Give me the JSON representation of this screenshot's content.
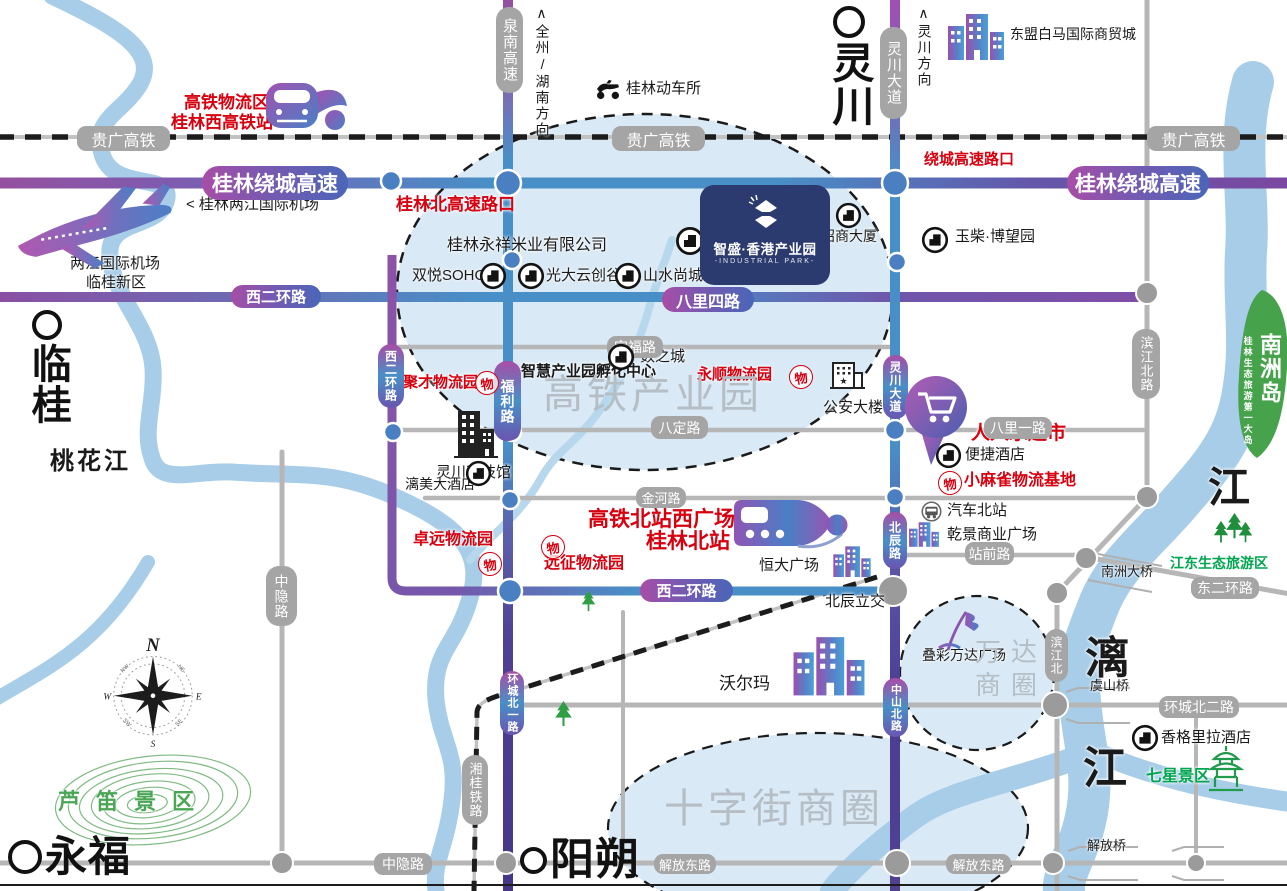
{
  "logo": {
    "title": "智盛·香港产业园",
    "subtitle": "-INDUSTRIAL PARK-"
  },
  "wu_stamp_char": "物",
  "compass": {
    "n": "N",
    "e": "E",
    "s": "S",
    "w": "W",
    "ne": "NE",
    "nw": "NW",
    "se": "SE",
    "sw": "SW"
  },
  "colors": {
    "red": "#d7000f",
    "navy_logo": "#2b3a6f",
    "road_purple": "#8a4fa0",
    "road_blue": "#488fc7",
    "gray_pill": "#a5a5a5",
    "river": "#a8cde8",
    "ellipse_fill": "#d9e9f5",
    "green": "#00a550",
    "island_green": "#46a24b",
    "district_gray": "#b5bdc5"
  },
  "map": {
    "cities": [
      {
        "n": "lingchuan-city",
        "t": "灵川",
        "x": 828,
        "y": 6,
        "vertical": true,
        "ring": 24,
        "fs": 42
      },
      {
        "n": "lingui-city",
        "t": "临桂",
        "x": 27,
        "y": 310,
        "vertical": true,
        "ring": 22,
        "fs": 40
      },
      {
        "n": "yongfu-city",
        "t": "永福",
        "x": 8,
        "y": 836,
        "vertical": false,
        "ring": 26,
        "fs": 42
      },
      {
        "n": "yangshuo-city",
        "t": "阳朔",
        "x": 520,
        "y": 838,
        "vertical": false,
        "ring": 19,
        "fs": 44
      }
    ],
    "labels": [
      {
        "n": "hsr-logistics-zone",
        "t": "高铁物流区",
        "x": 184,
        "y": 93,
        "fs": 17,
        "cls": "red"
      },
      {
        "n": "guilin-west-hsr-station",
        "t": "桂林西高铁站",
        "x": 171,
        "y": 113,
        "fs": 17,
        "cls": "red"
      },
      {
        "n": "guilin-north-expressway-exit",
        "t": "桂林北高速路口",
        "x": 396,
        "y": 195,
        "fs": 17,
        "cls": "red"
      },
      {
        "n": "ring-expressway-exit",
        "t": "绕城高速路口",
        "x": 924,
        "y": 151,
        "fs": 15,
        "cls": "red"
      },
      {
        "n": "yongshun-logistics-park",
        "t": "永顺物流园",
        "x": 697,
        "y": 366,
        "fs": 15,
        "cls": "red"
      },
      {
        "n": "jucai-logistics-park",
        "t": "聚才物流园",
        "x": 403,
        "y": 374,
        "fs": 15,
        "cls": "red"
      },
      {
        "n": "renrenle-supermarket",
        "t": "人人乐超市",
        "x": 971,
        "y": 423,
        "fs": 19,
        "cls": "red"
      },
      {
        "n": "xiaomaque-logistics-base",
        "t": "小麻雀物流基地",
        "x": 964,
        "y": 472,
        "fs": 16,
        "cls": "red"
      },
      {
        "n": "zhuoyuan-logistics-park",
        "t": "卓远物流园",
        "x": 413,
        "y": 531,
        "fs": 16,
        "cls": "red"
      },
      {
        "n": "yuanzheng-logistics-park",
        "t": "远征物流园",
        "x": 544,
        "y": 555,
        "fs": 16,
        "cls": "red"
      },
      {
        "n": "hsr-north-west-square",
        "t": "高铁北站西广场",
        "x": 588,
        "y": 508,
        "fs": 21,
        "cls": "red"
      },
      {
        "n": "guilin-north-station",
        "t": "桂林北站",
        "x": 646,
        "y": 530,
        "fs": 21,
        "cls": "red"
      },
      {
        "n": "guilin-emu-depot",
        "t": "桂林动车所",
        "x": 626,
        "y": 80,
        "fs": 15,
        "cls": "blk"
      },
      {
        "n": "asean-baima-trade-city",
        "t": "东盟白马国际商贸城",
        "x": 1010,
        "y": 26,
        "fs": 14,
        "cls": "blk"
      },
      {
        "n": "liangjiang-airport-pointer",
        "t": "< 桂林两江国际机场",
        "x": 186,
        "y": 196,
        "fs": 15,
        "cls": "blk"
      },
      {
        "n": "liangjiang-airport",
        "t": "两江国际机场",
        "x": 70,
        "y": 255,
        "fs": 15,
        "cls": "blk"
      },
      {
        "n": "lingui-new-district",
        "t": "临桂新区",
        "x": 86,
        "y": 274,
        "fs": 15,
        "cls": "blk"
      },
      {
        "n": "yongxiang-rice-company",
        "t": "桂林永祥米业有限公司",
        "x": 447,
        "y": 237,
        "fs": 16,
        "cls": "blk"
      },
      {
        "n": "zhaoshang-building",
        "t": "招商大厦",
        "x": 821,
        "y": 228,
        "fs": 14,
        "cls": "blk"
      },
      {
        "n": "yuchai-bowang-park",
        "t": "玉柴·博望园",
        "x": 955,
        "y": 228,
        "fs": 15,
        "cls": "blk"
      },
      {
        "n": "shuangyue-soho",
        "t": "双悦SOHO",
        "x": 412,
        "y": 267,
        "fs": 15,
        "cls": "blk"
      },
      {
        "n": "guangda-cloud-valley",
        "t": "光大云创谷",
        "x": 546,
        "y": 267,
        "fs": 15,
        "cls": "blk"
      },
      {
        "n": "shanshui-shangcheng",
        "t": "山水尚城",
        "x": 643,
        "y": 267,
        "fs": 15,
        "cls": "blk"
      },
      {
        "n": "shuzhicheng",
        "t": "数之城",
        "x": 640,
        "y": 348,
        "fs": 15,
        "cls": "blk"
      },
      {
        "n": "lingchuan-science-museum",
        "t": "灵川科技馆",
        "x": 436,
        "y": 464,
        "fs": 15,
        "cls": "blk"
      },
      {
        "n": "smart-park-incubator",
        "t": "智慧产业园孵化中心",
        "x": 521,
        "y": 363,
        "fs": 15,
        "cls": "blk bold"
      },
      {
        "n": "public-security-building",
        "t": "公安大楼",
        "x": 823,
        "y": 399,
        "fs": 15,
        "cls": "blk"
      },
      {
        "n": "limei-hotel",
        "t": "漓美大酒店",
        "x": 405,
        "y": 476,
        "fs": 14,
        "cls": "blk"
      },
      {
        "n": "bianjie-hotel",
        "t": "便捷酒店",
        "x": 965,
        "y": 446,
        "fs": 15,
        "cls": "blk"
      },
      {
        "n": "north-bus-station",
        "t": "汽车北站",
        "x": 947,
        "y": 502,
        "fs": 15,
        "cls": "blk"
      },
      {
        "n": "qianjing-plaza",
        "t": "乾景商业广场",
        "x": 947,
        "y": 526,
        "fs": 15,
        "cls": "blk"
      },
      {
        "n": "hengda-plaza",
        "t": "恒大广场",
        "x": 759,
        "y": 557,
        "fs": 15,
        "cls": "blk"
      },
      {
        "n": "beichen-interchange",
        "t": "北辰立交",
        "x": 825,
        "y": 593,
        "fs": 15,
        "cls": "blk"
      },
      {
        "n": "diecai-wanda-plaza",
        "t": "叠彩万达广场",
        "x": 922,
        "y": 647,
        "fs": 14,
        "cls": "blk"
      },
      {
        "n": "walmart",
        "t": "沃尔玛",
        "x": 719,
        "y": 674,
        "fs": 17,
        "cls": "blk"
      },
      {
        "n": "yushan-bridge",
        "t": "虞山桥",
        "x": 1090,
        "y": 678,
        "fs": 13,
        "cls": "blk"
      },
      {
        "n": "nanzhou-bridge",
        "t": "南洲大桥",
        "x": 1101,
        "y": 564,
        "fs": 13,
        "cls": "blk"
      },
      {
        "n": "shangri-la-hotel",
        "t": "香格里拉酒店",
        "x": 1161,
        "y": 729,
        "fs": 15,
        "cls": "blk"
      },
      {
        "n": "jiefang-bridge",
        "t": "解放桥",
        "x": 1087,
        "y": 838,
        "fs": 13,
        "cls": "blk"
      },
      {
        "n": "jiangdong-eco-tourism",
        "t": "江东生态旅游区",
        "x": 1170,
        "y": 555,
        "fs": 14,
        "cls": "grn"
      },
      {
        "n": "seven-star-park",
        "t": "七星景区",
        "x": 1146,
        "y": 768,
        "fs": 16,
        "cls": "grn"
      },
      {
        "n": "reed-flute-scenic-area",
        "t": "芦笛景区",
        "x": 58,
        "y": 789,
        "fs": 22,
        "cls": "ludi"
      },
      {
        "n": "taohua-river",
        "t": "桃花江",
        "x": 50,
        "y": 448,
        "fs": 24,
        "cls": "blk taohua"
      },
      {
        "n": "hsr-industrial-park-zone",
        "t": "高铁产业园",
        "x": 543,
        "y": 372,
        "fs": 40,
        "cls": "dist"
      },
      {
        "n": "shizijie-business-circle",
        "t": "十字街商圈",
        "x": 664,
        "y": 786,
        "fs": 40,
        "cls": "dist"
      },
      {
        "n": "wanda-business-circle",
        "t": "万达\n商圈",
        "x": 975,
        "y": 636,
        "fs": 26,
        "cls": "dist wanda"
      },
      {
        "n": "li-river-char-1",
        "t": "漓",
        "x": 1085,
        "y": 633,
        "fs": 44,
        "cls": "blk river-char"
      },
      {
        "n": "li-river-char-2",
        "t": "江",
        "x": 1083,
        "y": 743,
        "fs": 44,
        "cls": "blk river-char"
      },
      {
        "n": "li-river-char-3",
        "t": "江",
        "x": 1208,
        "y": 463,
        "fs": 42,
        "cls": "blk river-char"
      },
      {
        "n": "quanzhou-hunan-direction",
        "t": "∧全州/湖南方向",
        "x": 534,
        "y": 6,
        "fs": 14,
        "cls": "blk vert"
      },
      {
        "n": "lingchuan-direction",
        "t": "∧灵川方向",
        "x": 916,
        "y": 6,
        "fs": 14,
        "cls": "blk vert"
      },
      {
        "n": "nanzhou-island",
        "t": "南洲岛",
        "x": 1256,
        "y": 333,
        "fs": 22,
        "cls": "white vert"
      },
      {
        "n": "nanzhou-island-subtitle",
        "t": "桂林生态旅游第一大岛",
        "x": 1242,
        "y": 336,
        "fs": 9,
        "cls": "white vert"
      }
    ],
    "pills": [
      {
        "n": "guiguang-hsr-label-1",
        "t": "贵广高铁",
        "x": 77,
        "y": 126,
        "w": 93,
        "h": 25,
        "sty": "gray",
        "fs": 16
      },
      {
        "n": "guiguang-hsr-label-2",
        "t": "贵广高铁",
        "x": 612,
        "y": 126,
        "w": 93,
        "h": 25,
        "sty": "gray",
        "fs": 16
      },
      {
        "n": "guiguang-hsr-label-3",
        "t": "贵广高铁",
        "x": 1147,
        "y": 126,
        "w": 93,
        "h": 25,
        "sty": "gray",
        "fs": 16
      },
      {
        "n": "quannan-expressway",
        "t": "泉南高速",
        "x": 496,
        "y": 7,
        "w": 27,
        "h": 86,
        "sty": "gray",
        "vert": true,
        "fs": 15
      },
      {
        "n": "lingchuan-avenue-1",
        "t": "灵川大道",
        "x": 880,
        "y": 27,
        "w": 27,
        "h": 92,
        "sty": "gray",
        "vert": true,
        "fs": 15
      },
      {
        "n": "dingfu-road",
        "t": "定福路",
        "x": 607,
        "y": 336,
        "w": 56,
        "h": 22,
        "sty": "gray",
        "fs": 14
      },
      {
        "n": "bading-road",
        "t": "八定路",
        "x": 651,
        "y": 416,
        "w": 57,
        "h": 23,
        "sty": "gray",
        "fs": 14
      },
      {
        "n": "bali-1st-road",
        "t": "八里一路",
        "x": 984,
        "y": 417,
        "w": 68,
        "h": 22,
        "sty": "gray",
        "fs": 14
      },
      {
        "n": "jinhe-road",
        "t": "金河路",
        "x": 636,
        "y": 487,
        "w": 50,
        "h": 21,
        "sty": "gray",
        "fs": 13
      },
      {
        "n": "zhanqian-road",
        "t": "站前路",
        "x": 965,
        "y": 542,
        "w": 49,
        "h": 23,
        "sty": "gray",
        "fs": 14
      },
      {
        "n": "dong-2nd-ring-road",
        "t": "东二环路",
        "x": 1191,
        "y": 577,
        "w": 68,
        "h": 22,
        "sty": "gray",
        "fs": 14
      },
      {
        "n": "huancheng-north-2nd-road",
        "t": "环城北二路",
        "x": 1159,
        "y": 696,
        "w": 80,
        "h": 22,
        "sty": "gray",
        "fs": 14
      },
      {
        "n": "binjiang-north-road",
        "t": "滨江北路",
        "x": 1132,
        "y": 329,
        "w": 28,
        "h": 70,
        "sty": "gray",
        "vert": true,
        "fs": 13
      },
      {
        "n": "binjiang-north",
        "t": "滨江北",
        "x": 1045,
        "y": 629,
        "w": 23,
        "h": 53,
        "sty": "gray",
        "vert": true,
        "fs": 12
      },
      {
        "n": "zhongyin-road-v",
        "t": "中隐路",
        "x": 266,
        "y": 566,
        "w": 31,
        "h": 60,
        "sty": "gray",
        "vert": true,
        "fs": 14
      },
      {
        "n": "zhongyin-road-h",
        "t": "中隐路",
        "x": 374,
        "y": 853,
        "w": 58,
        "h": 22,
        "sty": "gray",
        "fs": 14
      },
      {
        "n": "jiefang-east-road-1",
        "t": "解放东路",
        "x": 654,
        "y": 854,
        "w": 62,
        "h": 20,
        "sty": "gray",
        "fs": 13
      },
      {
        "n": "jiefang-east-road-2",
        "t": "解放东路",
        "x": 946,
        "y": 854,
        "w": 65,
        "h": 20,
        "sty": "gray",
        "fs": 13
      },
      {
        "n": "xianggui-railway",
        "t": "湘桂铁路",
        "x": 462,
        "y": 755,
        "w": 26,
        "h": 70,
        "sty": "gray",
        "vert": true,
        "fs": 13
      },
      {
        "n": "guilin-ring-expressway-1",
        "t": "桂林绕城高速",
        "x": 202,
        "y": 166,
        "w": 146,
        "h": 34,
        "sty": "ph",
        "fs": 21
      },
      {
        "n": "guilin-ring-expressway-2",
        "t": "桂林绕城高速",
        "x": 1067,
        "y": 166,
        "w": 142,
        "h": 34,
        "sty": "ph",
        "fs": 21
      },
      {
        "n": "xi-2nd-ring-road-1",
        "t": "西二环路",
        "x": 231,
        "y": 285,
        "w": 90,
        "h": 23,
        "sty": "ph",
        "fs": 15
      },
      {
        "n": "bali-4th-road",
        "t": "八里四路",
        "x": 662,
        "y": 287,
        "w": 92,
        "h": 25,
        "sty": "ph",
        "fs": 16
      },
      {
        "n": "xi-2nd-ring-road-2",
        "t": "西二环路",
        "x": 640,
        "y": 579,
        "w": 93,
        "h": 23,
        "sty": "ph",
        "fs": 15
      },
      {
        "n": "fuli-road",
        "t": "福利路",
        "x": 494,
        "y": 361,
        "w": 27,
        "h": 80,
        "sty": "pv",
        "vert": true,
        "fs": 14
      },
      {
        "n": "xi-2nd-ring-road-v",
        "t": "西二环路",
        "x": 378,
        "y": 344,
        "w": 26,
        "h": 64,
        "sty": "pv",
        "vert": true,
        "fs": 12
      },
      {
        "n": "lingchuan-avenue-2",
        "t": "灵川大道",
        "x": 883,
        "y": 355,
        "w": 25,
        "h": 64,
        "sty": "pv",
        "vert": true,
        "fs": 12
      },
      {
        "n": "beichen-road",
        "t": "北辰路",
        "x": 883,
        "y": 512,
        "w": 24,
        "h": 57,
        "sty": "pv",
        "vert": true,
        "fs": 12
      },
      {
        "n": "zhongshan-north-road",
        "t": "中山北路",
        "x": 883,
        "y": 678,
        "w": 25,
        "h": 59,
        "sty": "pv",
        "vert": true,
        "fs": 11
      },
      {
        "n": "huancheng-north-1st-road",
        "t": "环城北一路",
        "x": 500,
        "y": 671,
        "w": 24,
        "h": 64,
        "sty": "pv",
        "vert": true,
        "fs": 11
      }
    ],
    "icons": [
      {
        "k": "trainf",
        "n": "west-hsr-train-icon",
        "x": 263,
        "y": 80,
        "w": 88,
        "h": 54
      },
      {
        "k": "plane",
        "n": "airplane-icon",
        "x": 12,
        "y": 186,
        "w": 168,
        "h": 84
      },
      {
        "k": "scooter",
        "n": "emu-depot-icon",
        "x": 594,
        "y": 78,
        "w": 28,
        "h": 22
      },
      {
        "k": "bgrad",
        "n": "trade-city-building-icon",
        "x": 946,
        "y": 10,
        "w": 60,
        "h": 52
      },
      {
        "k": "cbldg",
        "n": "rice-company-icon",
        "x": 675,
        "y": 226,
        "w": 30,
        "h": 30
      },
      {
        "k": "cbldg",
        "n": "zhaoshang-building-icon",
        "x": 835,
        "y": 202,
        "w": 27,
        "h": 27
      },
      {
        "k": "cbldg",
        "n": "yuchai-icon",
        "x": 921,
        "y": 226,
        "w": 28,
        "h": 28
      },
      {
        "k": "cbldg",
        "n": "soho-icon",
        "x": 479,
        "y": 262,
        "w": 28,
        "h": 28
      },
      {
        "k": "cbldg",
        "n": "guangda-icon",
        "x": 517,
        "y": 262,
        "w": 28,
        "h": 28
      },
      {
        "k": "cbldg",
        "n": "shanshui-icon",
        "x": 614,
        "y": 262,
        "w": 28,
        "h": 28
      },
      {
        "k": "cbldg",
        "n": "shuzhicheng-icon",
        "x": 607,
        "y": 343,
        "w": 28,
        "h": 28
      },
      {
        "k": "cbldg",
        "n": "limei-hotel-icon",
        "x": 465,
        "y": 460,
        "w": 27,
        "h": 27
      },
      {
        "k": "cbldg",
        "n": "bianjie-hotel-icon",
        "x": 935,
        "y": 442,
        "w": 27,
        "h": 27
      },
      {
        "k": "cbldg",
        "n": "shangri-la-icon",
        "x": 1131,
        "y": 724,
        "w": 28,
        "h": 28
      },
      {
        "k": "bline",
        "n": "science-museum-icon",
        "x": 450,
        "y": 405,
        "w": 52,
        "h": 57
      },
      {
        "k": "bstar",
        "n": "public-security-icon",
        "x": 829,
        "y": 360,
        "w": 37,
        "h": 34
      },
      {
        "k": "cart",
        "n": "supermarket-cart-icon",
        "x": 903,
        "y": 373,
        "w": 67,
        "h": 122
      },
      {
        "k": "trains",
        "n": "north-station-train-icon",
        "x": 728,
        "y": 492,
        "w": 120,
        "h": 64
      },
      {
        "k": "bgrad",
        "n": "hengda-building-icon",
        "x": 832,
        "y": 538,
        "w": 40,
        "h": 46
      },
      {
        "k": "bgrad",
        "n": "qianjing-building-icon",
        "x": 908,
        "y": 520,
        "w": 32,
        "h": 28
      },
      {
        "k": "bus",
        "n": "bus-station-icon",
        "x": 921,
        "y": 501,
        "w": 21,
        "h": 21
      },
      {
        "k": "flag",
        "n": "wanda-flag-icon",
        "x": 936,
        "y": 608,
        "w": 52,
        "h": 44
      },
      {
        "k": "bgrad",
        "n": "walmart-building-icon",
        "x": 791,
        "y": 630,
        "w": 76,
        "h": 70
      },
      {
        "k": "tree",
        "n": "tree-icon-1",
        "x": 580,
        "y": 590,
        "w": 17,
        "h": 22
      },
      {
        "k": "tree",
        "n": "tree-icon-2",
        "x": 553,
        "y": 700,
        "w": 21,
        "h": 27
      },
      {
        "k": "trees",
        "n": "eco-forest-icon",
        "x": 1212,
        "y": 512,
        "w": 42,
        "h": 34
      },
      {
        "k": "pagoda",
        "n": "seven-star-pagoda-icon",
        "x": 1207,
        "y": 745,
        "w": 38,
        "h": 48
      },
      {
        "k": "compass",
        "n": "compass-rose",
        "x": 100,
        "y": 636,
        "w": 106,
        "h": 112
      },
      {
        "k": "wu",
        "n": "wu-stamp-yongshun",
        "x": 789,
        "y": 365,
        "w": 22,
        "h": 22
      },
      {
        "k": "wu",
        "n": "wu-stamp-jucai",
        "x": 475,
        "y": 371,
        "w": 22,
        "h": 22
      },
      {
        "k": "wu",
        "n": "wu-stamp-xiaomaque",
        "x": 938,
        "y": 471,
        "w": 22,
        "h": 22
      },
      {
        "k": "wu",
        "n": "wu-stamp-zhuoyuan",
        "x": 478,
        "y": 552,
        "w": 22,
        "h": 22
      },
      {
        "k": "wu",
        "n": "wu-stamp-yuanzheng",
        "x": 541,
        "y": 535,
        "w": 22,
        "h": 22
      }
    ]
  }
}
